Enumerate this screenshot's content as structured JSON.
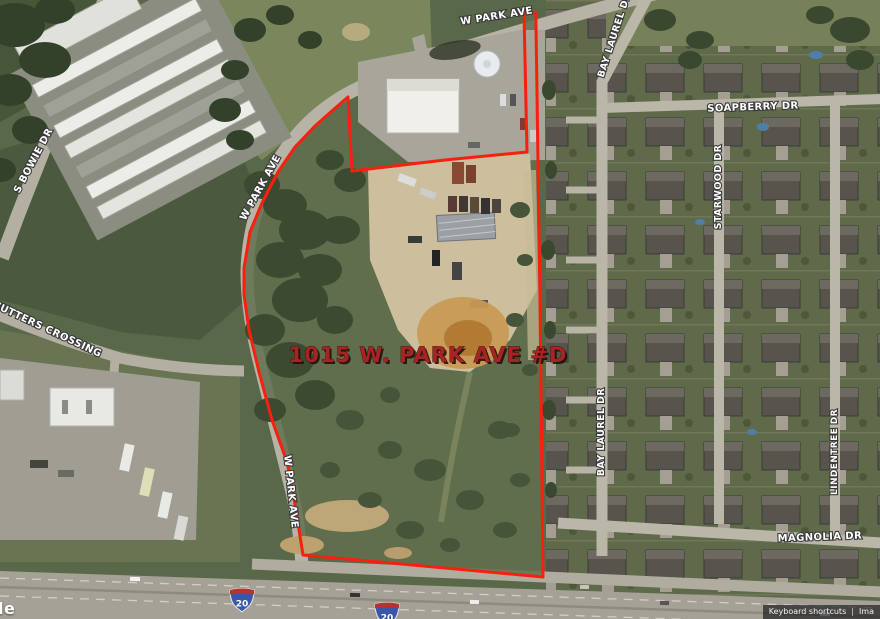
{
  "map": {
    "address_label": "1015 W. PARK AVE #D",
    "streets": {
      "w_park_ave": "W PARK AVE",
      "s_bowie_dr": "S BOWIE DR",
      "cutters_crossing": "CUTTERS CROSSING",
      "bay_laurel_dr": "BAY LAUREL DR",
      "soapberry_dr": "SOAPBERRY DR",
      "starwood_dr": "STARWOOD DR",
      "lindentree_dr": "LINDENTREE DR",
      "magnolia_dr": "MAGNOLIA DR"
    },
    "highway": {
      "shield_number": "20"
    },
    "colors": {
      "boundary_red": "#f91f0e",
      "address_red": "#a82424",
      "label_white": "#ffffff"
    }
  },
  "attribution": {
    "keyboard_shortcuts": "Keyboard shortcuts",
    "separator": "|",
    "imagery_partial": "Ima",
    "logo_partial": "le"
  }
}
